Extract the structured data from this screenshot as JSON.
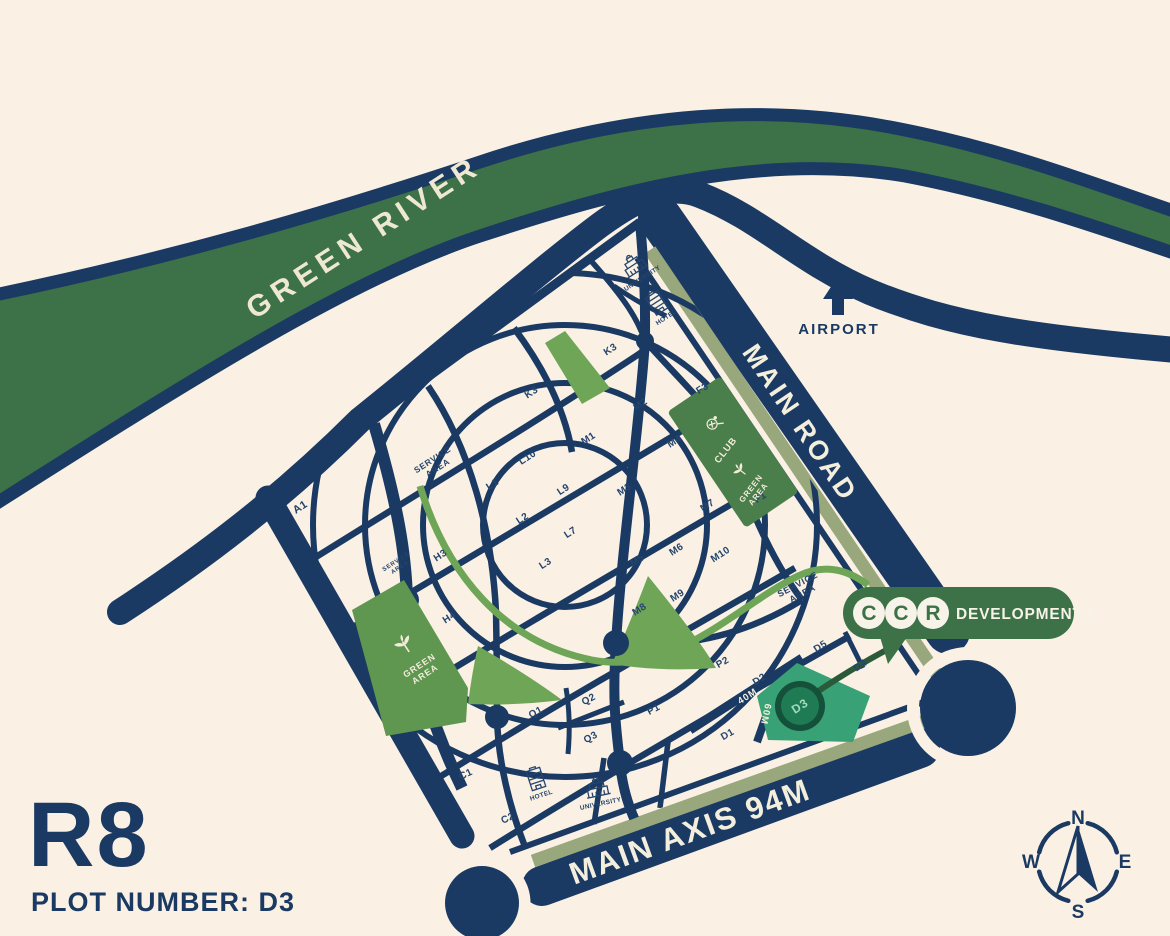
{
  "colors": {
    "background": "#faf1e4",
    "navy": "#1a3a63",
    "river_green": "#3d7147",
    "light_green": "#6fa557",
    "area_green": "#5f9650",
    "club_green": "#4a7e4b",
    "olive_stripe": "#99a77d",
    "highlight_green": "#38a175",
    "highlight_dark": "#1e7b54",
    "cream_text": "#f4eedd"
  },
  "river": {
    "label": "GREEN RIVER"
  },
  "airport": {
    "label": "AIRPORT"
  },
  "roads": {
    "main_road": "MAIN ROAD",
    "main_axis": "MAIN AXIS 94M",
    "width_40": "40M",
    "width_60": "60M"
  },
  "title": {
    "zone": "R8",
    "plot_line": "PLOT NUMBER: D3"
  },
  "logo": {
    "letter_1": "C",
    "letter_2": "C",
    "letter_3": "R",
    "name": "DEVELOPMENTS"
  },
  "compass": {
    "north": "N",
    "east": "E",
    "south": "S",
    "west": "W"
  },
  "highlight": {
    "label": "D3"
  },
  "map": {
    "plots": [
      {
        "label": "A1",
        "x": 302,
        "y": 510,
        "size": 11
      },
      {
        "label": "K3",
        "x": 533,
        "y": 395
      },
      {
        "label": "K3",
        "x": 612,
        "y": 352
      },
      {
        "label": "M2",
        "x": 642,
        "y": 407
      },
      {
        "label": "F3",
        "x": 704,
        "y": 391
      },
      {
        "label": "M1",
        "x": 590,
        "y": 441
      },
      {
        "label": "M4",
        "x": 676,
        "y": 444
      },
      {
        "label": "L10",
        "x": 529,
        "y": 460
      },
      {
        "label": "L1",
        "x": 494,
        "y": 487
      },
      {
        "label": "L9",
        "x": 565,
        "y": 492
      },
      {
        "label": "M3",
        "x": 626,
        "y": 492
      },
      {
        "label": "M7",
        "x": 709,
        "y": 508
      },
      {
        "label": "F1",
        "x": 762,
        "y": 500
      },
      {
        "label": "L2",
        "x": 524,
        "y": 521
      },
      {
        "label": "L7",
        "x": 572,
        "y": 535
      },
      {
        "label": "H3",
        "x": 442,
        "y": 558
      },
      {
        "label": "L3",
        "x": 547,
        "y": 566
      },
      {
        "label": "M5",
        "x": 639,
        "y": 563
      },
      {
        "label": "M6",
        "x": 678,
        "y": 552
      },
      {
        "label": "M10",
        "x": 722,
        "y": 557
      },
      {
        "label": "H4",
        "x": 451,
        "y": 620
      },
      {
        "label": "M8",
        "x": 641,
        "y": 612
      },
      {
        "label": "M9",
        "x": 679,
        "y": 598
      },
      {
        "label": "P2",
        "x": 724,
        "y": 665,
        "rot": -30
      },
      {
        "label": "P1",
        "x": 655,
        "y": 712,
        "rot": -28
      },
      {
        "label": "Q1",
        "x": 537,
        "y": 715,
        "rot": -28
      },
      {
        "label": "Q2",
        "x": 590,
        "y": 702,
        "rot": -28
      },
      {
        "label": "Q3",
        "x": 592,
        "y": 740,
        "rot": -28
      },
      {
        "label": "D5",
        "x": 822,
        "y": 649
      },
      {
        "label": "D4",
        "x": 862,
        "y": 668
      },
      {
        "label": "D2",
        "x": 761,
        "y": 682
      },
      {
        "label": "D1",
        "x": 729,
        "y": 737,
        "rot": -30
      },
      {
        "label": "C1",
        "x": 467,
        "y": 777,
        "rot": -25
      },
      {
        "label": "C2",
        "x": 509,
        "y": 821,
        "rot": -25
      }
    ],
    "areas": [
      {
        "lines": [
          "SERVICE",
          "AREA"
        ],
        "x": 434,
        "y": 462,
        "rot": -33,
        "size": 8.5,
        "tone": "navy"
      },
      {
        "lines": [
          "SERVICE",
          "AREA"
        ],
        "x": 397,
        "y": 563,
        "rot": -33,
        "size": 6,
        "tone": "navy"
      },
      {
        "lines": [
          "SERVICE",
          "AREA"
        ],
        "x": 799,
        "y": 587,
        "rot": -28,
        "size": 9,
        "tone": "navy"
      },
      {
        "lines": [
          "GREEN",
          "AREA"
        ],
        "x": 421,
        "y": 668,
        "rot": -33,
        "size": 9,
        "tone": "cream"
      },
      {
        "lines": [
          "CLUB"
        ],
        "x": 728,
        "y": 452,
        "rot": -52,
        "size": 9.5,
        "tone": "cream"
      },
      {
        "lines": [
          "GREEN",
          "AREA"
        ],
        "x": 753,
        "y": 490,
        "rot": -52,
        "size": 8,
        "tone": "cream"
      }
    ],
    "facilities": [
      {
        "icon": "university",
        "label": "UNIVERSITY",
        "x": 633,
        "y": 264,
        "rot": -33
      },
      {
        "icon": "hotel",
        "label": "HOTEL",
        "x": 657,
        "y": 303,
        "rot": -33
      },
      {
        "icon": "hotel",
        "label": "HOTEL",
        "x": 536,
        "y": 779,
        "rot": -18
      },
      {
        "icon": "university",
        "label": "UNIVERSITY",
        "x": 597,
        "y": 787,
        "rot": -12
      }
    ]
  }
}
